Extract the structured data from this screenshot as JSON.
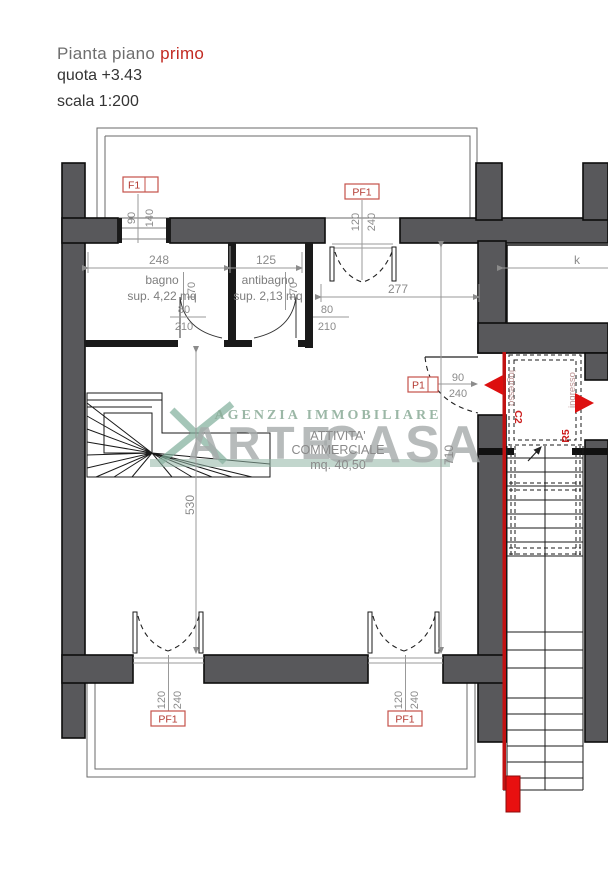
{
  "title": {
    "line1_gray": "Pianta piano",
    "line1_red": "primo",
    "line2": "quota +3.43",
    "line3": "scala 1:200"
  },
  "watermark": {
    "agency": "AGENZIA IMMOBILIARE",
    "brand_left": "ARTE",
    "brand_right": "CASA"
  },
  "rooms": {
    "bagno": {
      "name": "bagno",
      "area": "sup. 4,22 mq"
    },
    "antibagno": {
      "name": "antibagno",
      "area": "sup. 2,13 mq"
    },
    "commercial": {
      "line1": "ATTIVITA'",
      "line2": "COMMERCIALE",
      "line3": "mq. 40,50"
    }
  },
  "openings": {
    "f1": {
      "tag": "F1",
      "width": "90",
      "height": "140"
    },
    "pf1_top": {
      "tag": "PF1",
      "width": "120",
      "height": "240"
    },
    "pf1_bottom_left": {
      "tag": "PF1",
      "width": "120",
      "height": "240"
    },
    "pf1_bottom_right": {
      "tag": "PF1",
      "width": "120",
      "height": "240"
    },
    "p1": {
      "tag": "P1",
      "width": "90",
      "height": "240"
    },
    "bagno_door": {
      "width": "80",
      "height": "210"
    },
    "antibagno_door": {
      "width": "80",
      "height": "210"
    }
  },
  "dims": {
    "bagno_width": "248",
    "antibagno_width": "125",
    "hall_width": "277",
    "room_height_left": "530",
    "room_height_right": "710",
    "bagno_height_a": "170",
    "bagno_height_b": "170",
    "k": "k"
  },
  "stairwell": {
    "left_label": "ingresso",
    "right_label": "ingresso",
    "left_unit": "C2",
    "right_unit": "R5"
  }
}
